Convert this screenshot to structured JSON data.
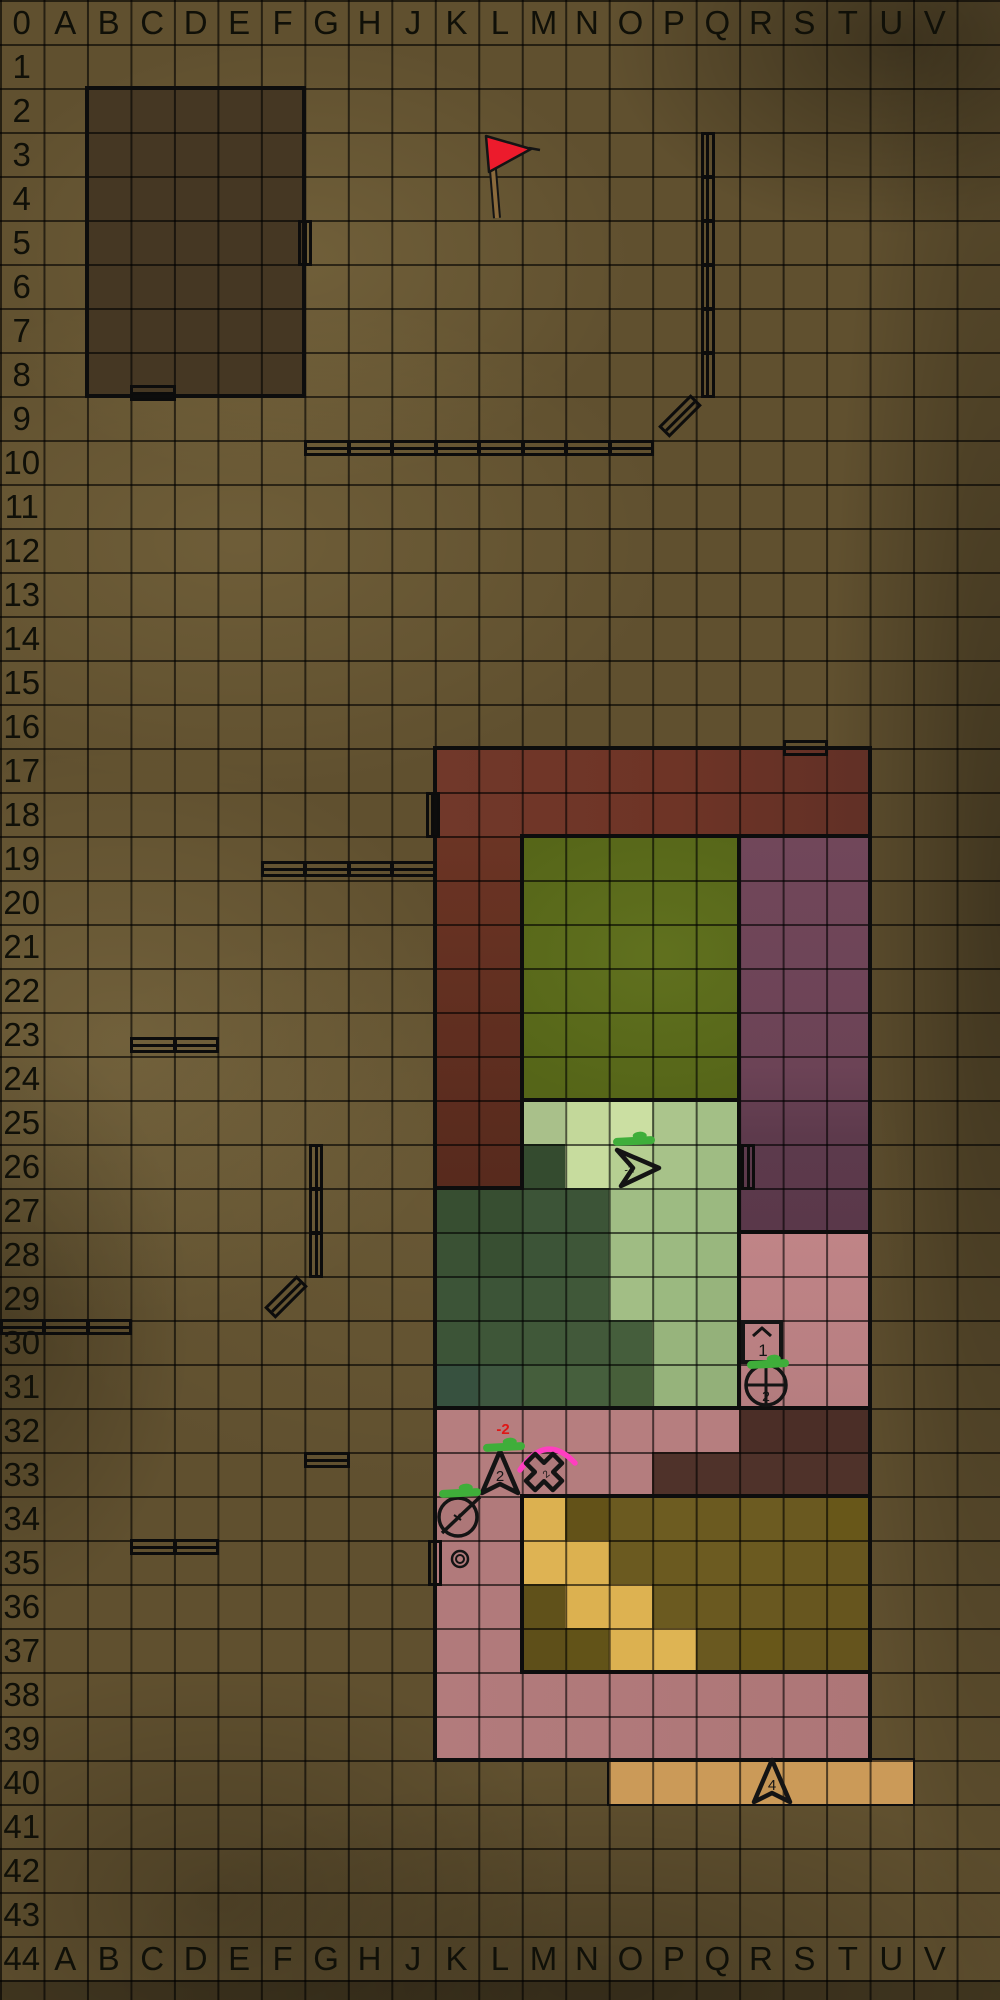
{
  "map": {
    "columns": [
      "0",
      "A",
      "B",
      "C",
      "D",
      "E",
      "F",
      "G",
      "H",
      "J",
      "K",
      "L",
      "M",
      "N",
      "O",
      "P",
      "Q",
      "R",
      "S",
      "T",
      "U",
      "V"
    ],
    "row_labels": [
      "1",
      "2",
      "3",
      "4",
      "5",
      "6",
      "7",
      "8",
      "9",
      "10",
      "11",
      "12",
      "13",
      "14",
      "15",
      "16",
      "17",
      "18",
      "19",
      "20",
      "21",
      "22",
      "23",
      "24",
      "25",
      "26",
      "27",
      "28",
      "29",
      "30",
      "31",
      "32",
      "33",
      "34",
      "35",
      "36",
      "37",
      "38",
      "39",
      "40",
      "41",
      "42",
      "43"
    ],
    "bottom_corner": "44"
  },
  "colors": {
    "background": "#60502f",
    "grid_line": "rgba(0,0,0,0.60)",
    "region_border": "#0d0d0d",
    "wall_line": "#0c0c0c",
    "hp_green": "#3fae3a",
    "arc_pink": "#ff3ec0",
    "damage_red": "#e01616",
    "flag_red": "#ec1b2c"
  },
  "regions": [
    {
      "name": "dark-room",
      "rect": [
        "B2",
        "F8"
      ],
      "fill": "#453723",
      "borderRect": 4
    },
    {
      "name": "red-hall-band",
      "rect": [
        "K17",
        "T18"
      ],
      "fill": "linear-gradient(90deg,#71382a 0%,#6e3426 55%,#613026 100%)"
    },
    {
      "name": "red-hall-arm",
      "rect": [
        "K19",
        "L26"
      ],
      "fill": "linear-gradient(180deg,#6b3424 0%,#572a1d 100%)"
    },
    {
      "name": "green-room",
      "rect": [
        "M19",
        "Q24"
      ],
      "fill": "radial-gradient(300px 220px at 62% 45%, rgba(195,215,90,0.10), transparent 70%) #556518",
      "borderRect": 4
    },
    {
      "name": "purple-room",
      "rect": [
        "R19",
        "T27"
      ],
      "fill": "linear-gradient(180deg,#71475a 0%,#6c4356 58%,#5d3a4c 76%,#5a384a 100%)",
      "borderRect": 4
    },
    {
      "name": "pink-room-upper",
      "rect": [
        "R28",
        "T31"
      ],
      "fill": "linear-gradient(180deg,#c08487,#b67e80)"
    },
    {
      "name": "pink-row32",
      "rect": [
        "K32",
        "Q32"
      ],
      "fill": "#b67e7f"
    },
    {
      "name": "pink-row33",
      "rect": [
        "K33",
        "O33"
      ],
      "fill": "#b47d7e"
    },
    {
      "name": "pink-left-column",
      "rect": [
        "K34",
        "L37"
      ],
      "fill": "#b17a7b"
    },
    {
      "name": "pink-room-lower",
      "rect": [
        "K38",
        "T39"
      ],
      "fill": "linear-gradient(90deg,#b27b7c,#ad7677)"
    },
    {
      "name": "dark-maroon-row32",
      "rect": [
        "R32",
        "T32"
      ],
      "fill": "#4b2e27"
    },
    {
      "name": "dark-maroon-row33",
      "rect": [
        "P33",
        "T33"
      ],
      "fill": "#4f322a"
    },
    {
      "name": "orange-corridor",
      "rect": [
        "O40",
        "U40"
      ],
      "fill": "#cb9a58",
      "borderRect": 2
    }
  ],
  "region_cells": {
    "meadow": {
      "M25": "#a9c08a",
      "N25": "#c3d89a",
      "O25": "#cbdfa2",
      "P25": "#abc58c",
      "Q25": "#a3bf86",
      "N26": "#c7dc9e",
      "O26": "#b6cf92",
      "P26": "#a7c289",
      "Q26": "#9fbc83",
      "O27": "#a0bd84",
      "P27": "#9dbb82",
      "Q27": "#9bb980",
      "O28": "#9fbc83",
      "P28": "#9cba81",
      "Q28": "#99b77e",
      "O29": "#a2be85",
      "P29": "#9bb980",
      "Q29": "#97b47c",
      "P30": "#97b47c",
      "Q30": "#94b17a",
      "P31": "#96b37b",
      "Q31": "#93b079"
    },
    "forest": {
      "M26": "#344b2f",
      "K27": "#374e31",
      "L27": "#374e31",
      "M27": "#3c5437",
      "N27": "#3c5437",
      "K28": "#3a5134",
      "L28": "#384f32",
      "M28": "#3c5437",
      "N28": "#3e5638",
      "K29": "#3c5437",
      "L29": "#3c5437",
      "M29": "#3e5638",
      "N29": "#405839",
      "K30": "#3c5437",
      "L30": "#3e5638",
      "M30": "#405839",
      "N30": "#42593a",
      "O30": "#455e3c",
      "K31": "#37513f",
      "L31": "#3e5740",
      "M31": "#455e3c",
      "N31": "#465f3d",
      "O31": "#475f3a"
    },
    "yellow_room": {
      "M34": "#dcb150",
      "N34": "#635218",
      "O34": "#6b5a20",
      "P34": "#6d5c21",
      "Q34": "#6b5a20",
      "R34": "#6c5b21",
      "S34": "#6a5920",
      "T34": "#685719",
      "M35": "#deb353",
      "N35": "#dcb150",
      "O35": "#6b5a20",
      "P35": "#6b5a20",
      "Q35": "#6c5b21",
      "R35": "#6b5a20",
      "S35": "#695820",
      "T35": "#67561f",
      "M36": "#60511a",
      "N36": "#dcb150",
      "O36": "#ddb251",
      "P36": "#6b5a20",
      "Q36": "#6a5920",
      "R36": "#695820",
      "S36": "#67561f",
      "T36": "#66551e",
      "M37": "#5e4f19",
      "N37": "#625318",
      "O37": "#dcb150",
      "P37": "#deb453",
      "Q37": "#6a5920",
      "R37": "#685719",
      "S37": "#66551e",
      "T37": "#65541d"
    }
  },
  "yellow_room_border": {
    "rect": [
      "M34",
      "T37"
    ],
    "width": 4
  },
  "border_segments": [
    {
      "kind": "h",
      "col": "K",
      "row": 17,
      "len": 10
    },
    {
      "kind": "v",
      "col": "U",
      "row": 17,
      "len": 2
    },
    {
      "kind": "h",
      "col": "M",
      "row": 19,
      "len": 8
    },
    {
      "kind": "v",
      "col": "M",
      "row": 19,
      "len": 8
    },
    {
      "kind": "h",
      "col": "K",
      "row": 27,
      "len": 2
    },
    {
      "kind": "v",
      "col": "K",
      "row": 17,
      "len": 10
    },
    {
      "kind": "h",
      "col": "M",
      "row": 25,
      "len": 5
    },
    {
      "kind": "v",
      "col": "M",
      "row": 25,
      "len": 2
    },
    {
      "kind": "v",
      "col": "K",
      "row": 27,
      "len": 5
    },
    {
      "kind": "h",
      "col": "K",
      "row": 32,
      "len": 10
    },
    {
      "kind": "v",
      "col": "R",
      "row": 28,
      "len": 4
    },
    {
      "kind": "v",
      "col": "U",
      "row": 28,
      "len": 12
    },
    {
      "kind": "h",
      "col": "K",
      "row": 40,
      "len": 10
    },
    {
      "kind": "v",
      "col": "K",
      "row": 32,
      "len": 8
    }
  ],
  "walls": [
    {
      "name": "door-f5",
      "kind": "v",
      "col": "G",
      "row": 5,
      "len": 1,
      "shift": 1,
      "door": true
    },
    {
      "name": "door-c8",
      "kind": "h",
      "col": "C",
      "row": 9,
      "len": 1,
      "shift": -3,
      "door": true
    },
    {
      "name": "wall-q3-q8",
      "kind": "v",
      "col": "Q",
      "row": 3,
      "len": 6,
      "shift": 12
    },
    {
      "name": "door-p9-diagonal",
      "kind": "diag",
      "cx": 680,
      "cy": 416,
      "door": true
    },
    {
      "name": "wall-g10-o10",
      "kind": "h",
      "col": "G",
      "row": 10,
      "len": 8,
      "shift": 8
    },
    {
      "name": "door-s16",
      "kind": "h",
      "col": "S",
      "row": 17,
      "len": 1,
      "shift": 0,
      "door": true
    },
    {
      "name": "door-j18",
      "kind": "v",
      "col": "K",
      "row": 18,
      "len": 1,
      "shift": -2,
      "door": true
    },
    {
      "name": "wall-f19-j19",
      "kind": "h",
      "col": "F",
      "row": 20,
      "len": 4,
      "shift": -11
    },
    {
      "name": "wall-c23-d23",
      "kind": "h",
      "col": "C",
      "row": 24,
      "len": 2,
      "shift": -11
    },
    {
      "name": "door-q26",
      "kind": "v",
      "col": "R",
      "row": 26,
      "len": 1,
      "shift": 9,
      "door": true
    },
    {
      "name": "wall-g26-g28",
      "kind": "v",
      "col": "G",
      "row": 26,
      "len": 3,
      "shift": 12
    },
    {
      "name": "door-f29-diagonal",
      "kind": "diag",
      "cx": 286,
      "cy": 1297,
      "door": true
    },
    {
      "name": "wall-row30-left",
      "kind": "h",
      "col": "0",
      "row": 30,
      "len": 3,
      "shift": 7
    },
    {
      "name": "wall-g33",
      "kind": "h",
      "col": "G",
      "row": 33,
      "len": 1,
      "shift": 8
    },
    {
      "name": "wall-c35-d35",
      "kind": "h",
      "col": "C",
      "row": 35,
      "len": 2,
      "shift": 7
    },
    {
      "name": "door-j35",
      "kind": "v",
      "col": "K",
      "row": 35,
      "len": 1,
      "shift": 0,
      "door": true
    }
  ],
  "tokens": [
    {
      "type": "flag",
      "name": "red-flag",
      "x": 497,
      "y": 218
    },
    {
      "type": "arrow-right",
      "name": "unit-arrow-1",
      "cx": 632,
      "cy": 1167,
      "label": "-1",
      "hp": {
        "x": 634,
        "y": 1141
      }
    },
    {
      "type": "box-number",
      "name": "marker-box-1",
      "cx": 762,
      "cy": 1342,
      "label": "1"
    },
    {
      "type": "circle-cross",
      "name": "unit-crosshair-2",
      "cx": 766,
      "cy": 1385,
      "label": "2",
      "hp": {
        "x": 768,
        "y": 1364
      }
    },
    {
      "type": "arrow-up",
      "name": "unit-arrow-2",
      "cx": 500,
      "cy": 1473,
      "label": "2",
      "hp": {
        "x": 504,
        "y": 1447
      }
    },
    {
      "type": "x-token",
      "name": "unit-x",
      "cx": 544,
      "cy": 1472,
      "label": "2",
      "arc": true
    },
    {
      "type": "circle-slash",
      "name": "unit-slash",
      "cx": 458,
      "cy": 1517,
      "hp": {
        "x": 460,
        "y": 1493
      }
    },
    {
      "type": "ring",
      "name": "loot-ring",
      "cx": 460,
      "cy": 1559
    },
    {
      "type": "arrow-up",
      "name": "unit-arrow-4",
      "cx": 772,
      "cy": 1782,
      "label": "4"
    }
  ],
  "damage_texts": [
    {
      "text": "-2",
      "x": 492,
      "y": 1422,
      "color": "#e01616"
    }
  ]
}
